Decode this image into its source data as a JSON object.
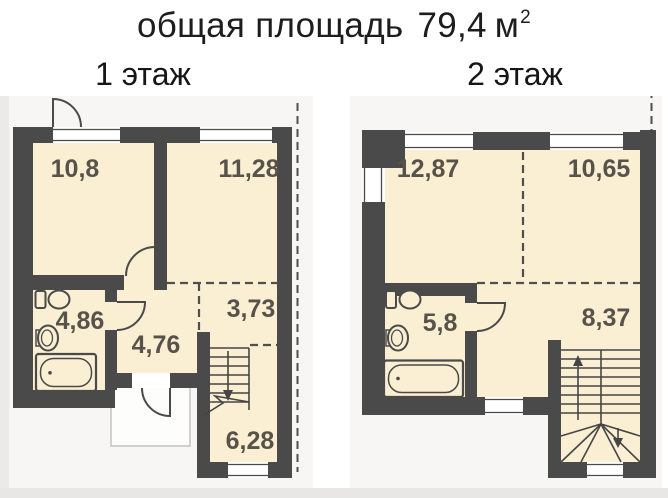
{
  "page": {
    "title": {
      "label": "общая площадь",
      "value": "79,4",
      "unit": "м",
      "superscript": "2"
    }
  },
  "floors": [
    {
      "label": "1 этаж",
      "rooms": [
        {
          "id": "room-top-left",
          "area": "10,8"
        },
        {
          "id": "room-top-right",
          "area": "11,28"
        },
        {
          "id": "room-middle",
          "area": "3,73"
        },
        {
          "id": "bathroom",
          "area": "4,86"
        },
        {
          "id": "hallway",
          "area": "4,76"
        },
        {
          "id": "stair-room",
          "area": "6,28"
        }
      ]
    },
    {
      "label": "2 этаж",
      "rooms": [
        {
          "id": "room-top-left",
          "area": "12,87"
        },
        {
          "id": "room-top-right",
          "area": "10,65"
        },
        {
          "id": "bathroom",
          "area": "5,8"
        },
        {
          "id": "stair-hall",
          "area": "8,37"
        }
      ]
    }
  ],
  "colors": {
    "wall": "#4a4a4a",
    "floor_fill": "#faefd3",
    "room_label_text": "#57524a",
    "title_text": "#1d1d1d",
    "dashed_line": "#4f4f4f",
    "plan_background": "#f7f6f4",
    "porch_fill": "#fdfdfc",
    "page_background": "#ffffff"
  }
}
